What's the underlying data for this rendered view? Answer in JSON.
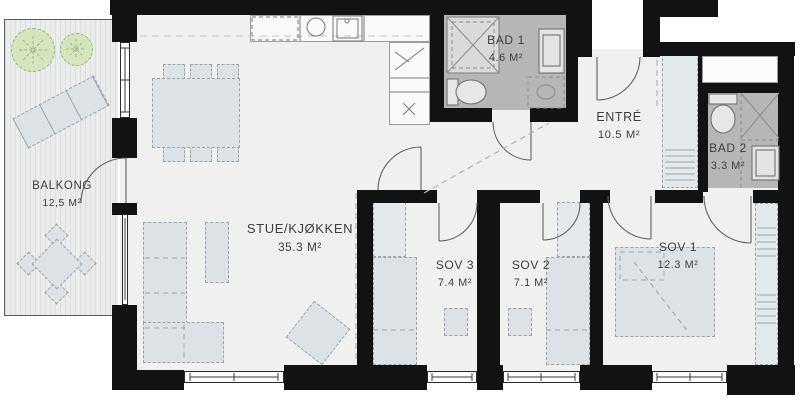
{
  "plan": {
    "title": "Apartment floor plan",
    "rooms": [
      {
        "name": "BALKONG",
        "area": "12,5 M²"
      },
      {
        "name": "STUE/KJØKKEN",
        "area": "35.3 M²"
      },
      {
        "name": "BAD 1",
        "area": "4.6 M²"
      },
      {
        "name": "ENTRÉ",
        "area": "10.5 M²"
      },
      {
        "name": "BAD 2",
        "area": "3.3 M²"
      },
      {
        "name": "SOV 1",
        "area": "12.3 M²"
      },
      {
        "name": "SOV 2",
        "area": "7.1 M²"
      },
      {
        "name": "SOV 3",
        "area": "7.4 M²"
      }
    ],
    "colors": {
      "wall": "#121212",
      "floor": "#f0f1ef",
      "bathroom_floor": "#b5b6b5",
      "furniture": "#dce2e5",
      "tree": "#d5e6bc"
    }
  }
}
